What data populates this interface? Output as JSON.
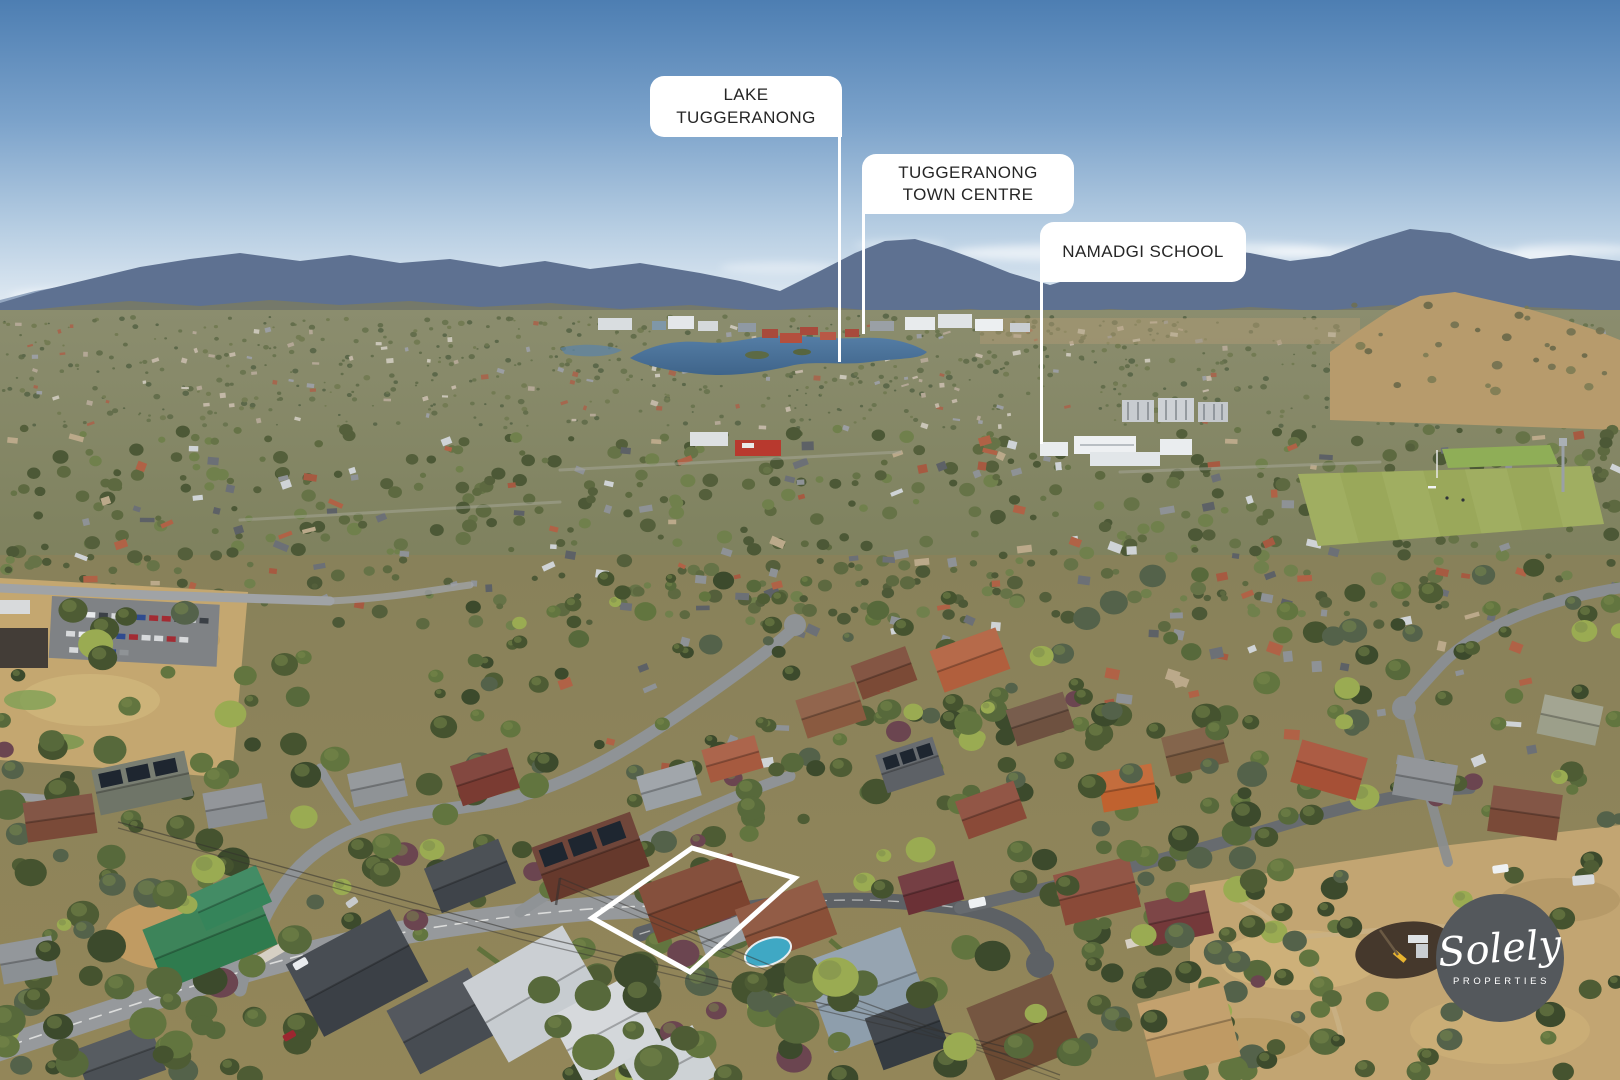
{
  "callouts": [
    {
      "id": "lake-tuggeranong",
      "lines": [
        "LAKE",
        "TUGGERANONG"
      ]
    },
    {
      "id": "tuggeranong-town-centre",
      "lines": [
        "TUGGERANONG",
        "TOWN CENTRE"
      ]
    },
    {
      "id": "namadgi-school",
      "lines": [
        "NAMADGI SCHOOL"
      ]
    }
  ],
  "watermark": {
    "brand": "Solely",
    "sub": "PROPERTIES"
  },
  "colors": {
    "callout_bg": "#ffffff",
    "callout_text": "#262626",
    "leader_line": "#ffffff",
    "property_outline": "#ffffff",
    "watermark_bg": "#54585c",
    "watermark_text": "#ffffff",
    "sky_top": "#4d7eb2",
    "sky_horizon": "#e6eef5",
    "mountain": "#5e7191",
    "lake": "#4d7399",
    "sports_field": "#9aa85a",
    "dry_grass": "#c4a770",
    "suburb_olive": "#7c7f5b"
  }
}
